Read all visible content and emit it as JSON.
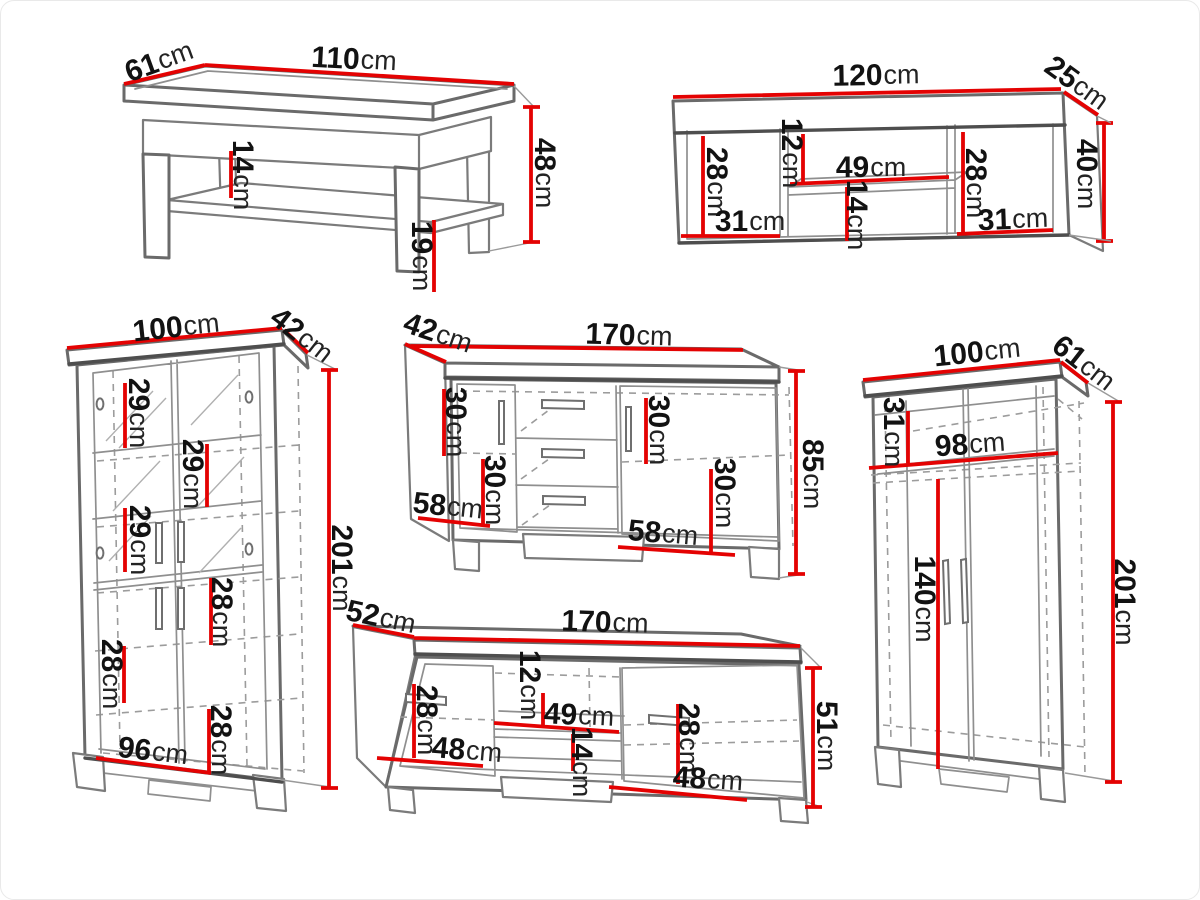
{
  "page": {
    "background": "#ffffff",
    "dimension_color": "#e40202",
    "drawing_color": "#6a6a6a",
    "unit": "cm"
  },
  "items": {
    "coffee_table": {
      "width": {
        "v": "110",
        "u": "cm"
      },
      "depth": {
        "v": "61",
        "u": "cm"
      },
      "height": {
        "v": "48",
        "u": "cm"
      },
      "shelf_clearance": {
        "v": "14",
        "u": "cm"
      },
      "floor_clearance": {
        "v": "19",
        "u": "cm"
      }
    },
    "wall_shelf": {
      "width": {
        "v": "120",
        "u": "cm"
      },
      "depth": {
        "v": "25",
        "u": "cm"
      },
      "height": {
        "v": "40",
        "u": "cm"
      },
      "left_height": {
        "v": "28",
        "u": "cm"
      },
      "niche_top": {
        "v": "12",
        "u": "cm"
      },
      "niche_width": {
        "v": "49",
        "u": "cm"
      },
      "niche_bottom": {
        "v": "14",
        "u": "cm"
      },
      "right_height": {
        "v": "28",
        "u": "cm"
      },
      "left_width": {
        "v": "31",
        "u": "cm"
      },
      "right_width": {
        "v": "31",
        "u": "cm"
      }
    },
    "display_cabinet": {
      "width": {
        "v": "100",
        "u": "cm"
      },
      "depth": {
        "v": "42",
        "u": "cm"
      },
      "height": {
        "v": "201",
        "u": "cm"
      },
      "gap1": {
        "v": "29",
        "u": "cm"
      },
      "gap2": {
        "v": "29",
        "u": "cm"
      },
      "gap3": {
        "v": "29",
        "u": "cm"
      },
      "gap4": {
        "v": "28",
        "u": "cm"
      },
      "gap5": {
        "v": "28",
        "u": "cm"
      },
      "gap6": {
        "v": "28",
        "u": "cm"
      },
      "inner_width": {
        "v": "96",
        "u": "cm"
      }
    },
    "sideboard": {
      "depth": {
        "v": "42",
        "u": "cm"
      },
      "width": {
        "v": "170",
        "u": "cm"
      },
      "height": {
        "v": "85",
        "u": "cm"
      },
      "left_gap1": {
        "v": "30",
        "u": "cm"
      },
      "left_gap2": {
        "v": "30",
        "u": "cm"
      },
      "left_width": {
        "v": "58",
        "u": "cm"
      },
      "right_gap1": {
        "v": "30",
        "u": "cm"
      },
      "right_gap2": {
        "v": "30",
        "u": "cm"
      },
      "right_width": {
        "v": "58",
        "u": "cm"
      }
    },
    "wardrobe": {
      "width": {
        "v": "100",
        "u": "cm"
      },
      "depth": {
        "v": "61",
        "u": "cm"
      },
      "height": {
        "v": "201",
        "u": "cm"
      },
      "top_gap": {
        "v": "31",
        "u": "cm"
      },
      "inner_width": {
        "v": "98",
        "u": "cm"
      },
      "door_height": {
        "v": "140",
        "u": "cm"
      }
    },
    "tv_stand": {
      "depth": {
        "v": "52",
        "u": "cm"
      },
      "width": {
        "v": "170",
        "u": "cm"
      },
      "height": {
        "v": "51",
        "u": "cm"
      },
      "left_gap": {
        "v": "28",
        "u": "cm"
      },
      "left_width": {
        "v": "48",
        "u": "cm"
      },
      "niche_top": {
        "v": "12",
        "u": "cm"
      },
      "niche_width": {
        "v": "49",
        "u": "cm"
      },
      "niche_bottom": {
        "v": "14",
        "u": "cm"
      },
      "right_gap": {
        "v": "28",
        "u": "cm"
      },
      "right_width": {
        "v": "48",
        "u": "cm"
      }
    }
  }
}
